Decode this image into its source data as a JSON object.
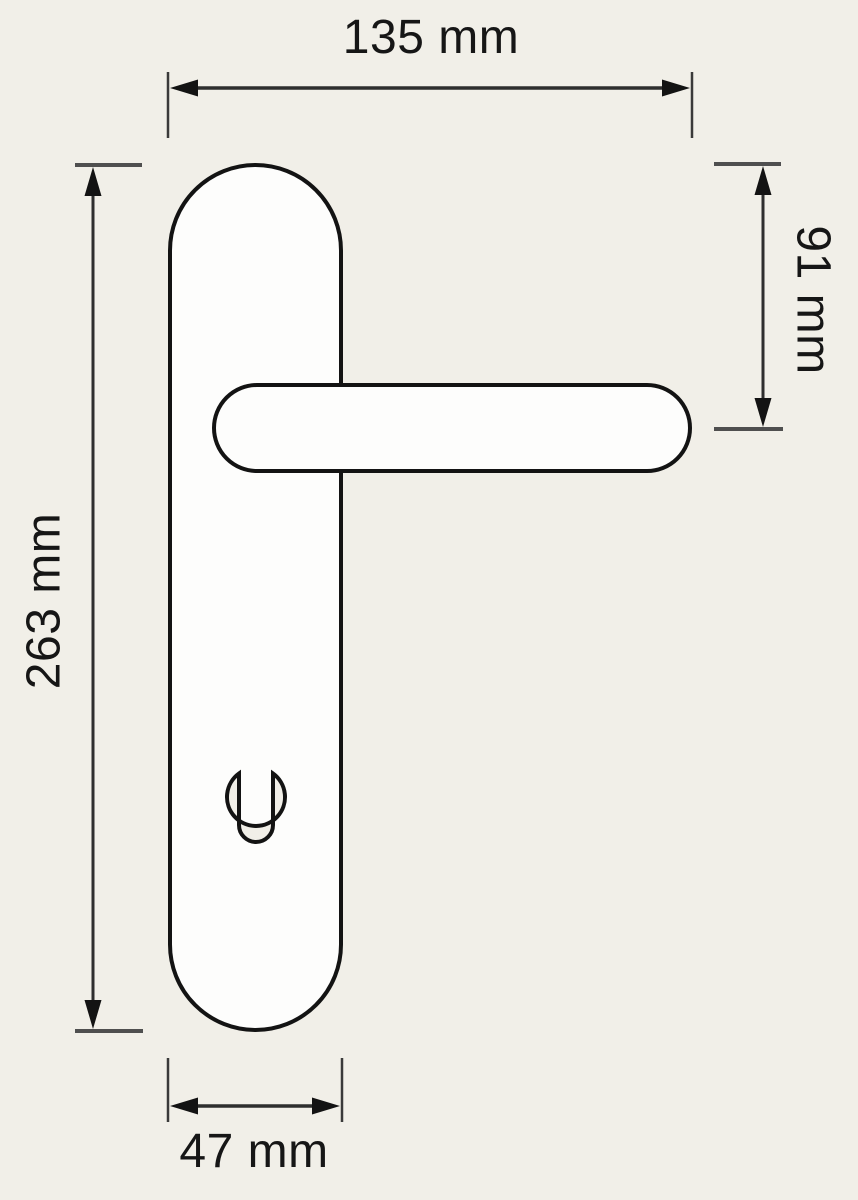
{
  "figure": {
    "kind": "technical-dimension-drawing",
    "dimension_labels": {
      "top": "135 mm",
      "right": "91 mm",
      "left": "263 mm",
      "bottom": "47 mm"
    },
    "dimension_values": {
      "overall_width_mm": 135,
      "plate_top_to_handle_axis_mm": 91,
      "plate_height_mm": 263,
      "plate_width_mm": 47
    },
    "colors": {
      "background": "#f1efe8",
      "shape_fill": "#fdfdfc",
      "outline": "#131313",
      "dimension_line": "#2e2e2e",
      "extension_tick": "#4f4f4f",
      "label_text": "#161616"
    }
  }
}
